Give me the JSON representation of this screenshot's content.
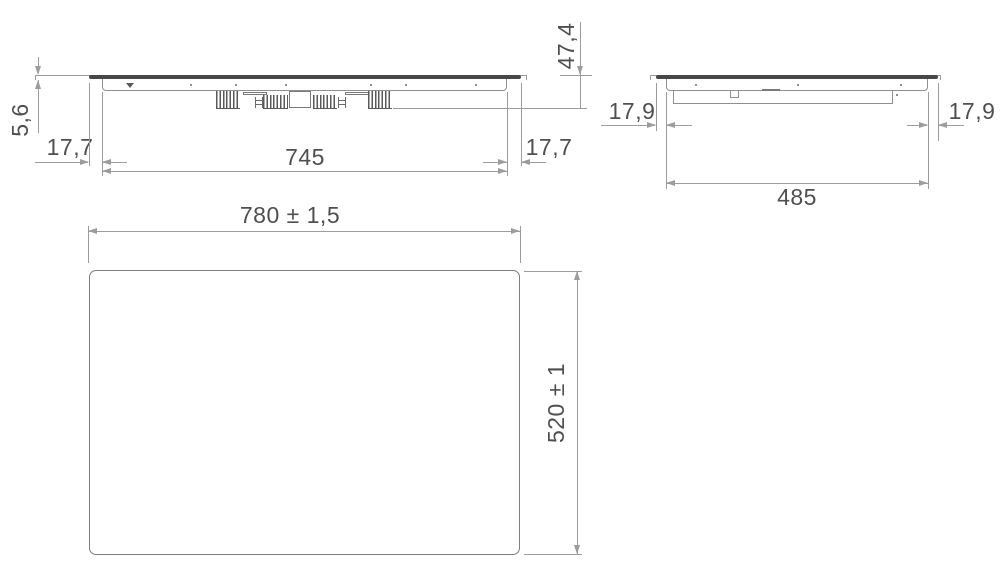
{
  "front_view": {
    "glass_thickness": "5,6",
    "overhang_left": "17,7",
    "body_width": "745",
    "overhang_right": "17,7",
    "total_height": "47,4"
  },
  "side_view": {
    "overhang_left": "17,9",
    "overhang_right": "17,9",
    "body_depth": "485"
  },
  "plan_view": {
    "width": "780 ± 1,5",
    "depth": "520 ± 1"
  },
  "colors": {
    "line": "#9c9c9c",
    "glass": "#474747",
    "text": "#4f4f4f",
    "background": "#ffffff"
  }
}
